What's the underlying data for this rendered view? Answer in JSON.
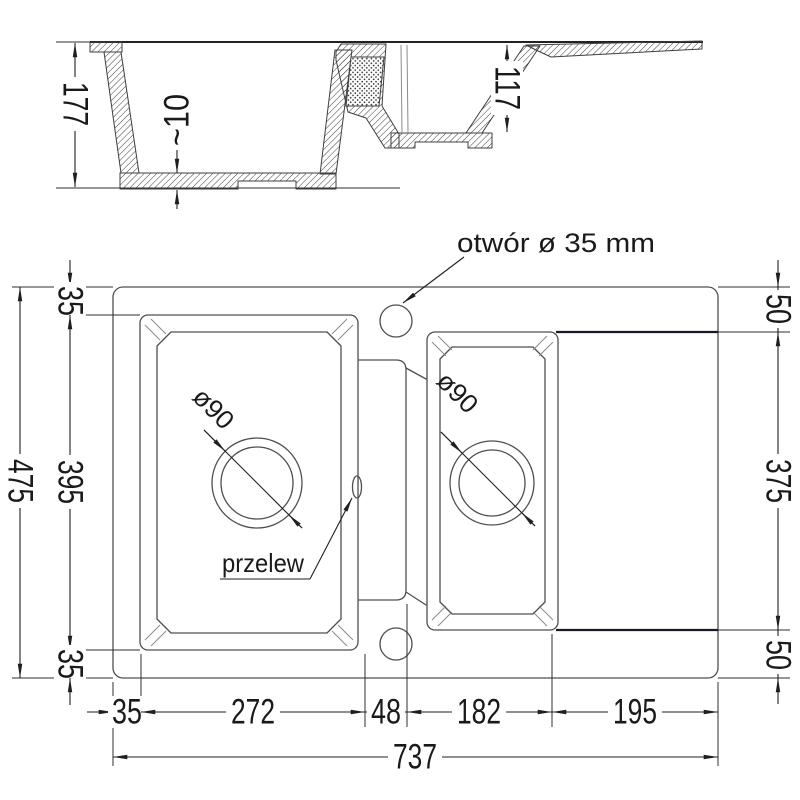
{
  "drawing": {
    "section": {
      "depth_main": "177",
      "floor_thickness": "~10",
      "depth_small": "117"
    },
    "plan": {
      "faucet_label": "otwór ø 35 mm",
      "overflow_label": "przelew",
      "drain_main_label": "ø90",
      "drain_small_label": "ø90",
      "left": {
        "overall": "475",
        "top": "35",
        "bowl": "395",
        "bottom": "35"
      },
      "right": {
        "top": "50",
        "middle": "375",
        "bottom": "50"
      },
      "bottom": {
        "margin_left": "35",
        "bowl_main": "272",
        "divider": "48",
        "bowl_small": "182",
        "drainer": "195",
        "overall": "737"
      }
    },
    "colors": {
      "outline": "#4f4f4f",
      "dimension": "#1f1f1f",
      "drainer_edge": "#181830",
      "background": "#ffffff"
    }
  }
}
